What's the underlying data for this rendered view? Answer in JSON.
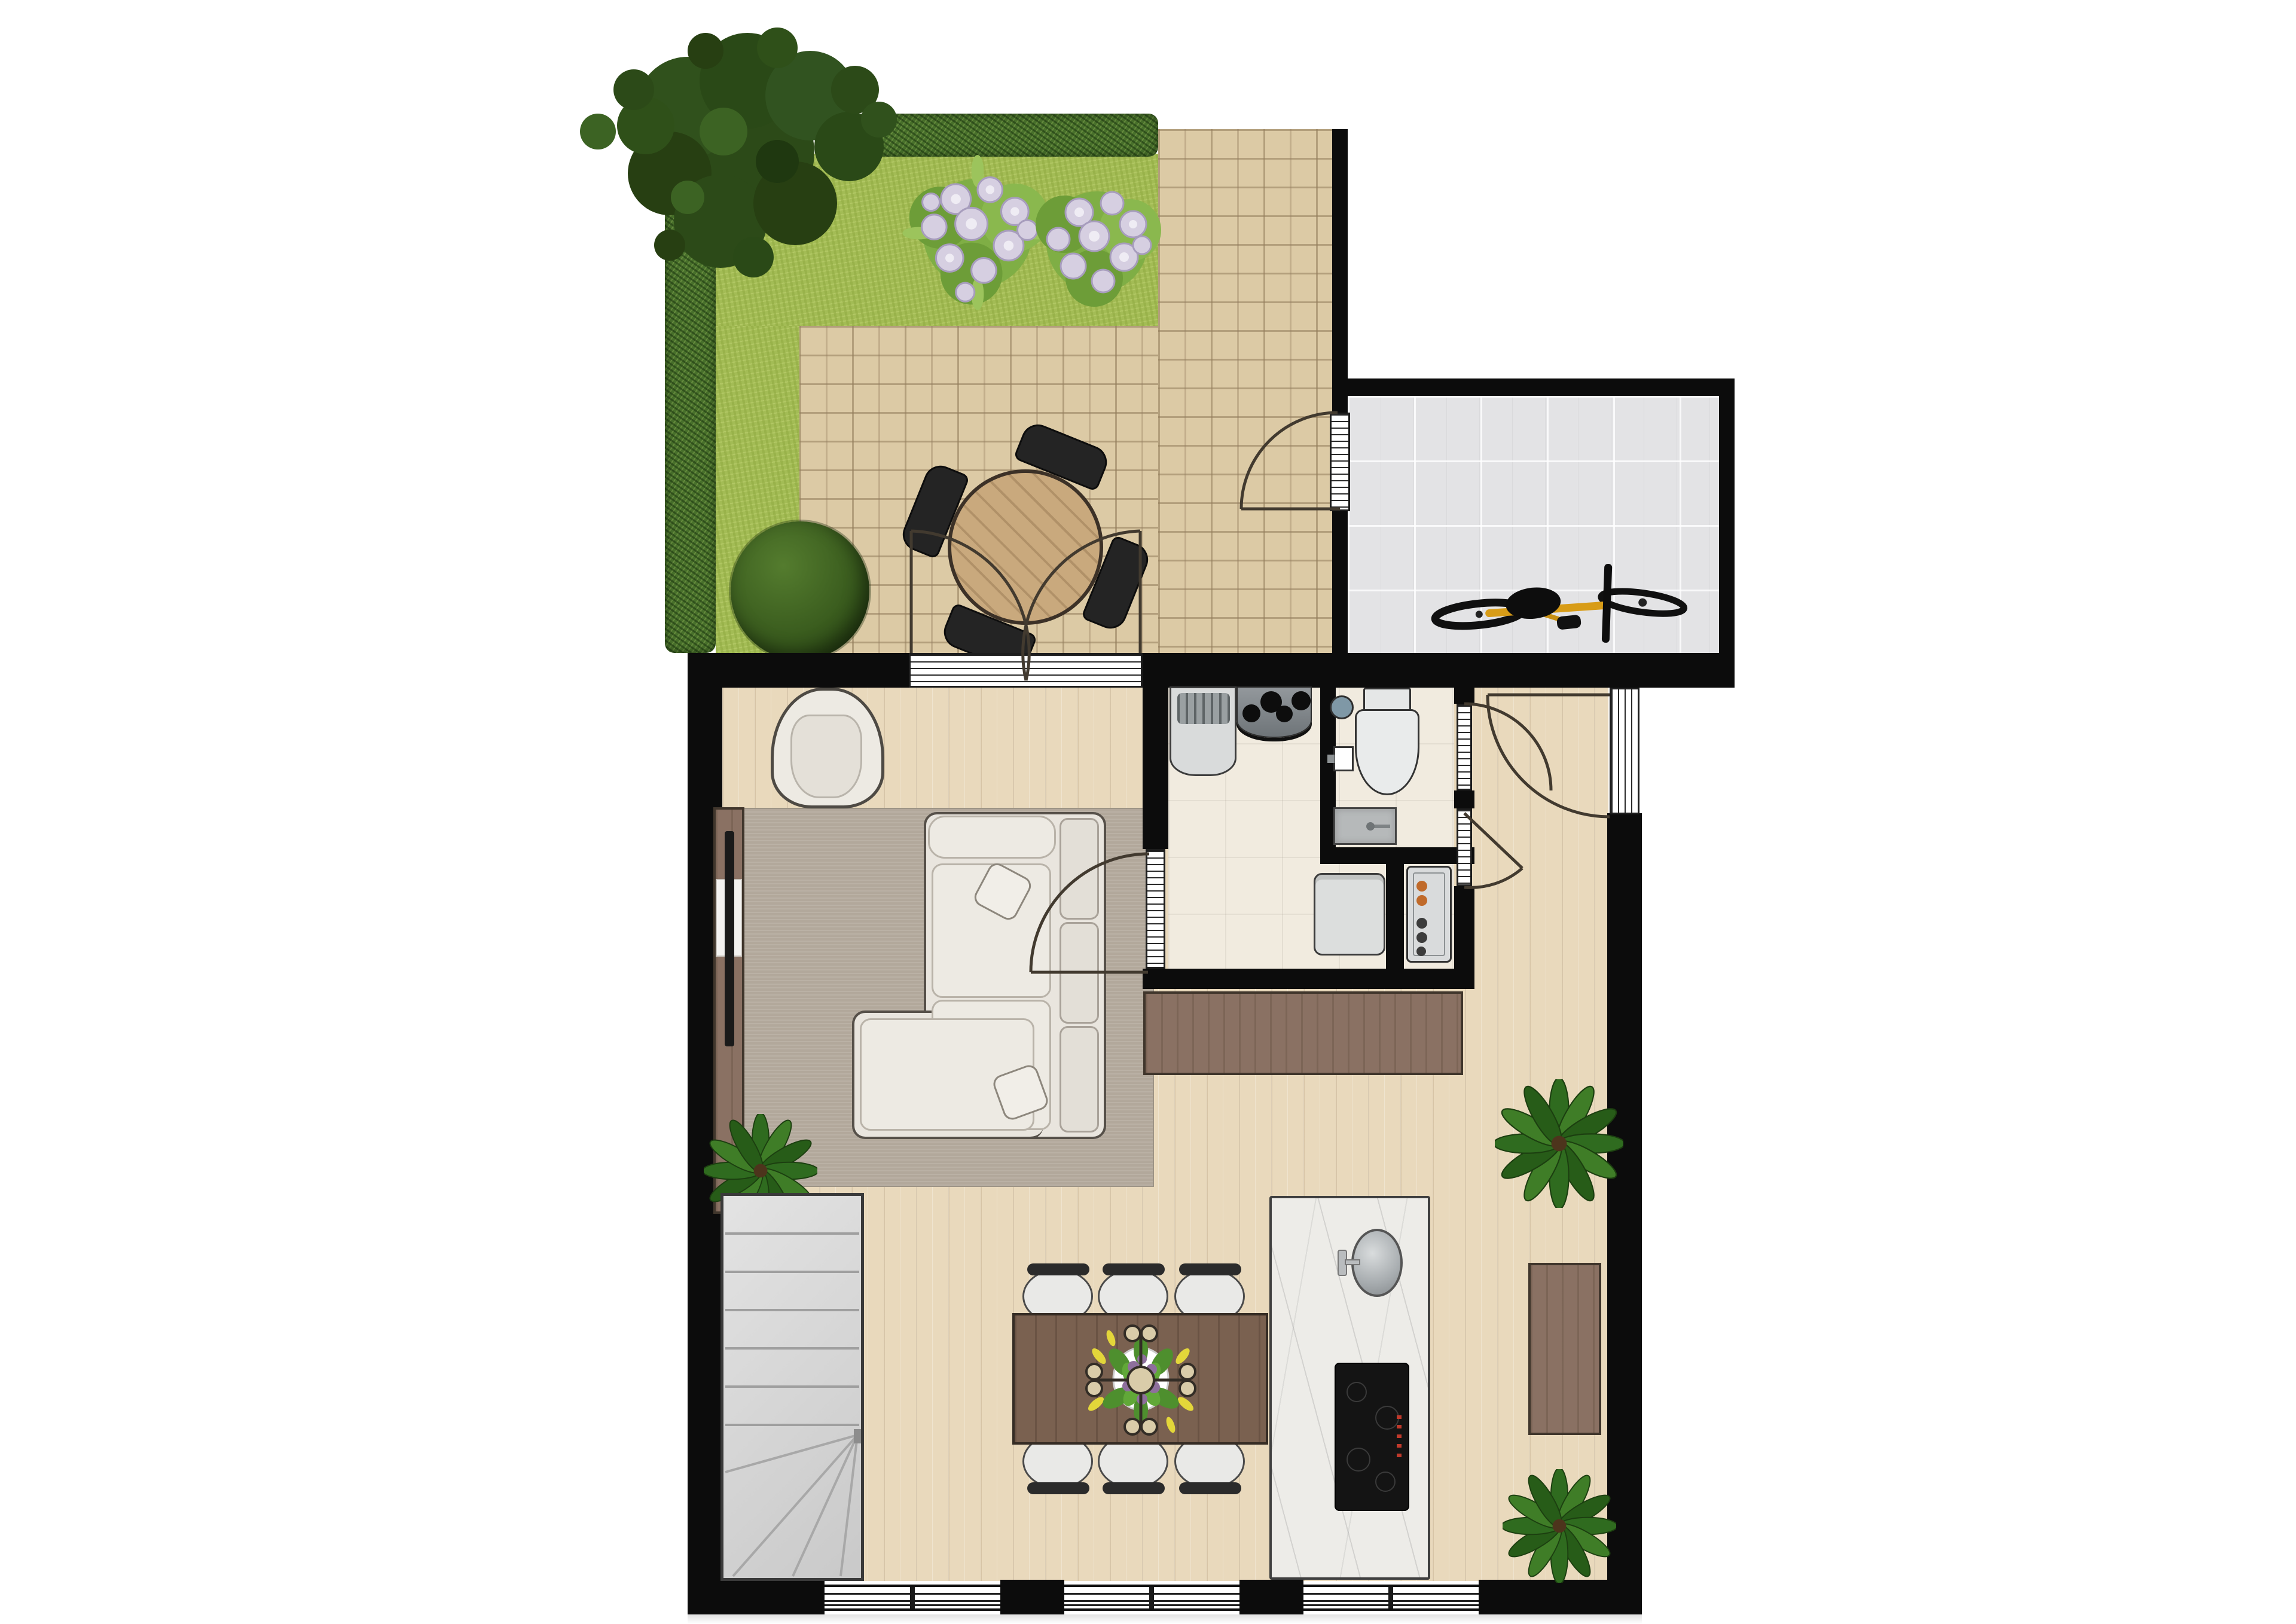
{
  "app": {
    "name": "residential-floor-plan",
    "view": "top-down-2d-render",
    "visible_text": "none"
  },
  "palette": {
    "wall": "#0c0c0c",
    "wood_floor": "#e9d9bc",
    "tile_floor": "#f1ebdf",
    "garage_floor": "#e3e3e5",
    "patio": "#dccaa5",
    "grass": "#a3bc55",
    "hedge": "#48702b",
    "tree": "#2c4a18",
    "rug": "#b2a89b",
    "sofa": "#e9e5de",
    "furniture_brown": "#8a7163",
    "dining_table": "#7a6150",
    "island_marble": "#edece8",
    "stairs": "#d6d6d6",
    "bike_frame": "#d89c17",
    "flowers": "#d6cfe1",
    "door_arc": "#423a2f"
  },
  "rooms": {
    "garden": {
      "label": "Garden terrace",
      "features": [
        "lawn",
        "hedge-left",
        "hedge-top",
        "tree",
        "flower-bed",
        "flower-bed",
        "boxwood-bush",
        "paved-patio",
        "outdoor-dining-set"
      ]
    },
    "garage": {
      "label": "Storage / garage",
      "features": [
        "tiled-floor",
        "bicycle"
      ]
    },
    "living": {
      "label": "Living room",
      "features": [
        "armchair",
        "corner-sofa",
        "rug",
        "tv-console",
        "plant"
      ]
    },
    "kitchen": {
      "label": "Kitchen & dining area",
      "features": [
        "dining-table",
        "six-chairs",
        "centerpiece",
        "kitchen-island",
        "round-sink",
        "induction-hob",
        "sideboard",
        "plants",
        "staircase"
      ]
    },
    "utility": {
      "label": "Utility room",
      "features": [
        "sink-unit-with-rack",
        "gas-hob",
        "washing-machine"
      ]
    },
    "bathroom": {
      "label": "Bathroom",
      "features": [
        "toilet",
        "toilet-brush-vase",
        "hand-basin",
        "shower-tray"
      ]
    },
    "closet": {
      "label": "Boiler closet",
      "features": [
        "boiler-unit"
      ]
    },
    "hall": {
      "label": "Entrance hall",
      "features": [
        "front-door",
        "bathroom-door",
        "closet-door"
      ]
    }
  },
  "doors": [
    {
      "id": "french-doors",
      "label": "Double french doors patio-living",
      "type": "double-swing"
    },
    {
      "id": "patio-garage-door",
      "label": "Patio to garage door",
      "type": "swing"
    },
    {
      "id": "front-door",
      "label": "Front entrance door",
      "type": "swing"
    },
    {
      "id": "utility-door",
      "label": "Living to utility door",
      "type": "swing"
    },
    {
      "id": "bathroom-door",
      "label": "Bathroom door",
      "type": "swing"
    },
    {
      "id": "closet-door",
      "label": "Boiler closet door",
      "type": "swing"
    }
  ],
  "windows": [
    {
      "id": "window-left",
      "label": "Bottom facade window 1"
    },
    {
      "id": "window-middle",
      "label": "Bottom facade window 2"
    },
    {
      "id": "window-right",
      "label": "Bottom facade window 3"
    }
  ],
  "counts": {
    "dining_chairs": 6,
    "patio_chairs": 4,
    "indoor_plants": 3,
    "flower_beds": 2
  }
}
